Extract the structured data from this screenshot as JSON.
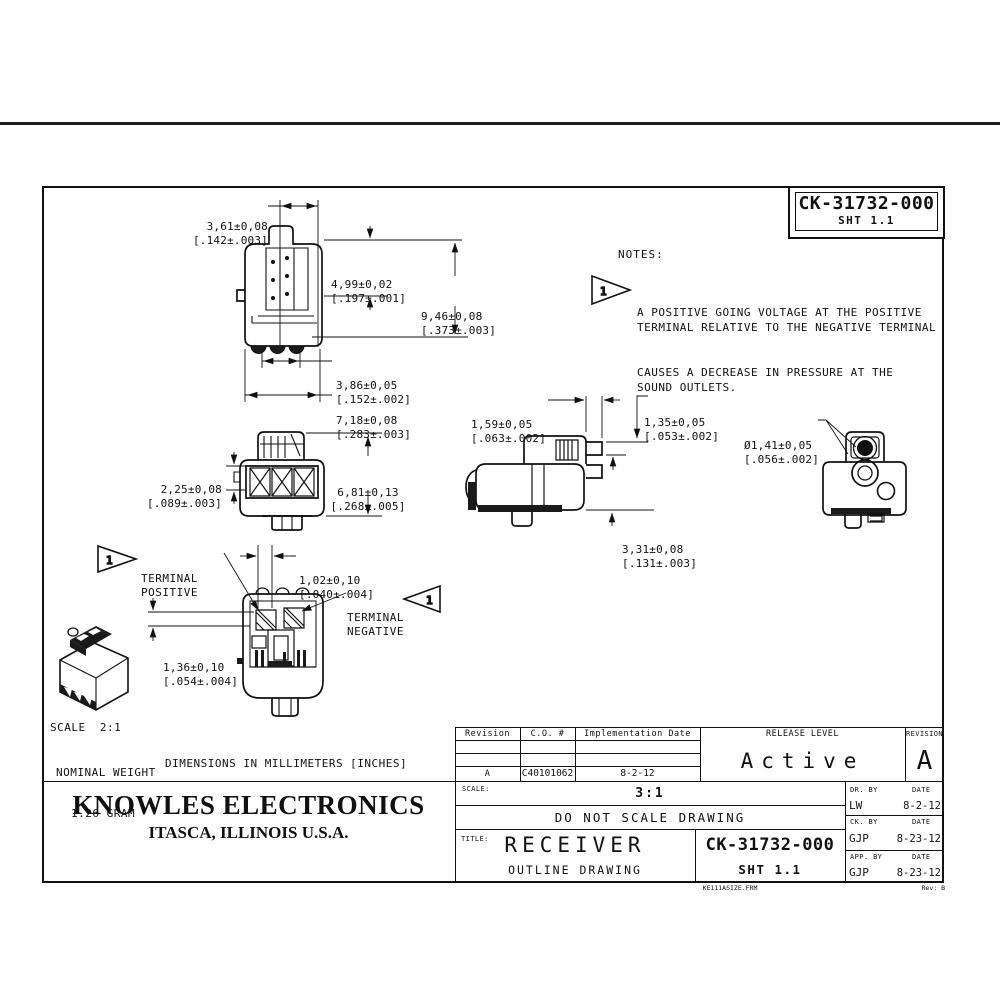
{
  "header": {
    "part_number": "CK-31732-000",
    "sheet": "SHT 1.1"
  },
  "notes": {
    "heading": "NOTES:",
    "flag_number": "1",
    "lines": [
      "A POSITIVE GOING VOLTAGE AT THE POSITIVE",
      "TERMINAL RELATIVE TO THE NEGATIVE TERMINAL",
      "CAUSES A DECREASE IN PRESSURE AT THE",
      "SOUND OUTLETS."
    ]
  },
  "views": {
    "front": {
      "dims": {
        "width_top": {
          "mm": "3,61±0,08",
          "in": "[.142±.003]"
        },
        "port_offset": {
          "mm": "4,99±0,02",
          "in": "[.197±.001]"
        },
        "height": {
          "mm": "9,46±0,08",
          "in": "[.373±.003]"
        },
        "pad_pitch": {
          "mm": "3,86±0,05",
          "in": "[.152±.002]"
        },
        "width": {
          "mm": "7,18±0,08",
          "in": "[.283±.003]"
        }
      }
    },
    "back": {
      "dims": {
        "band": {
          "mm": "2,25±0,08",
          "in": "[.089±.003]"
        },
        "height": {
          "mm": "6,81±0,13",
          "in": "[.268±.005]"
        }
      }
    },
    "side": {
      "dims": {
        "offset": {
          "mm": "1,59±0,05",
          "in": "[.063±.002]"
        },
        "terminal": {
          "mm": "1,35±0,05",
          "in": "[.053±.002]"
        },
        "base": {
          "mm": "3,31±0,08",
          "in": "[.131±.003]"
        }
      }
    },
    "top": {
      "dims": {
        "outlet": {
          "mm": "Ø1,41±0,05",
          "in": "[.056±.002]"
        }
      }
    },
    "bottom": {
      "labels": {
        "positive": [
          "TERMINAL",
          "POSITIVE"
        ],
        "negative": [
          "TERMINAL",
          "NEGATIVE"
        ],
        "flag": "1"
      },
      "dims": {
        "gap": {
          "mm": "1,02±0,10",
          "in": "[.040±.004]"
        },
        "pad": {
          "mm": "1,36±0,10",
          "in": "[.054±.004]"
        }
      }
    },
    "iso": {
      "scale": "SCALE  2:1",
      "weight_lines": [
        "NOMINAL WEIGHT",
        "1.26 GRAM"
      ]
    }
  },
  "units_note": "DIMENSIONS IN MILLIMETERS [INCHES]",
  "company": {
    "name": "KNOWLES ELECTRONICS",
    "location": "ITASCA, ILLINOIS U.S.A."
  },
  "title_block": {
    "revision_table": {
      "headers": [
        "Revision",
        "C.O. #",
        "Implementation Date"
      ],
      "rows": [
        [
          "",
          "",
          ""
        ],
        [
          "",
          "",
          ""
        ],
        [
          "A",
          "C40101062",
          "8-2-12"
        ]
      ]
    },
    "release": {
      "label": "RELEASE LEVEL",
      "value": "Active"
    },
    "revision": {
      "label": "REVISION",
      "value": "A"
    },
    "scale": {
      "label": "SCALE:",
      "value": "3:1"
    },
    "do_not_scale": "DO NOT SCALE DRAWING",
    "title": {
      "label": "TITLE:",
      "value": "RECEIVER",
      "subtitle": "OUTLINE DRAWING"
    },
    "part_number": "CK-31732-000",
    "sheet": "SHT 1.1",
    "signatures": [
      {
        "role": "DR. BY",
        "name": "LW",
        "date_label": "DATE",
        "date": "8-2-12"
      },
      {
        "role": "CK. BY",
        "name": "GJP",
        "date_label": "DATE",
        "date": "8-23-12"
      },
      {
        "role": "APP. BY",
        "name": "GJP",
        "date_label": "DATE",
        "date": "8-23-12"
      }
    ],
    "form": {
      "file": "KE111ASIZE.FRM",
      "rev": "Rev: B"
    }
  }
}
